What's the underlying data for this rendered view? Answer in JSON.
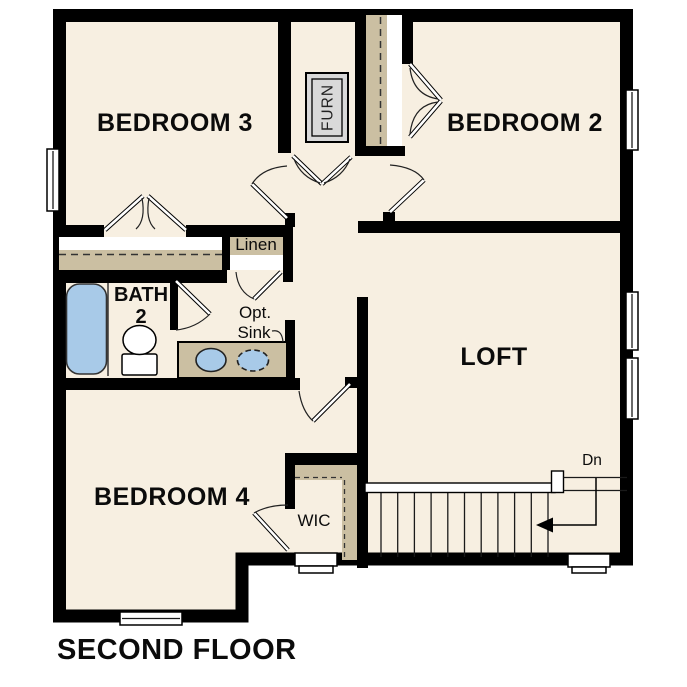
{
  "title": "SECOND FLOOR",
  "rooms": {
    "bedroom3": "BEDROOM 3",
    "bedroom2": "BEDROOM 2",
    "loft": "LOFT",
    "bedroom4": "BEDROOM 4"
  },
  "bath": {
    "name": "BATH",
    "number": "2"
  },
  "closets": {
    "linen": "Linen",
    "wic": "WIC"
  },
  "fixtures": {
    "furnace": "FURN",
    "optional_sink_line1": "Opt.",
    "optional_sink_line2": "Sink"
  },
  "stairs": {
    "direction_label": "Dn"
  },
  "colors": {
    "background": "#ffffff",
    "floor": "#f7efe1",
    "wall": "#000000",
    "closet_shelf": "#cbbfa2",
    "fixture_blue": "#a8cae8",
    "furnace_fill": "#d9d9d9"
  }
}
